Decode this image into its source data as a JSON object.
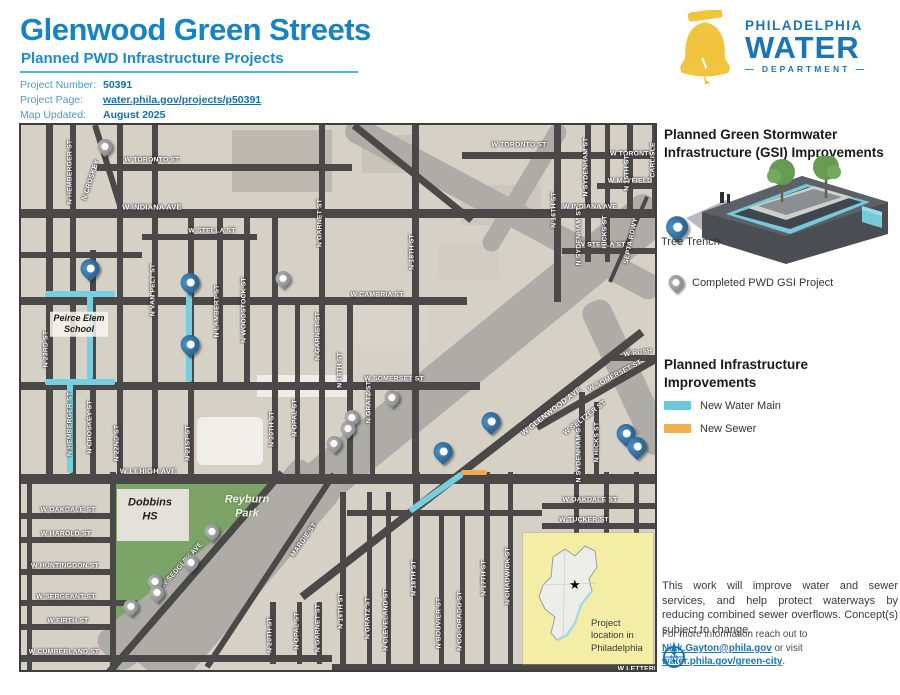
{
  "header": {
    "title": "Glenwood Green Streets",
    "subtitle": "Planned PWD Infrastructure Projects",
    "info": [
      {
        "label": "Project Number:",
        "value": "50391",
        "link": false
      },
      {
        "label": "Project Page:",
        "value": "water.phila.gov/projects/p50391",
        "link": true
      },
      {
        "label": "Map Updated:",
        "value": "August 2025",
        "link": false
      }
    ],
    "logo": {
      "line1": "PHILADELPHIA",
      "line2": "WATER",
      "line3": "DEPARTMENT"
    }
  },
  "colors": {
    "brand_blue": "#1b74b8",
    "title_blue": "#1583c4",
    "bell_yellow": "#f0c43c",
    "water_main": "#74d0e0",
    "sewer": "#f0a94e",
    "pin_blue": "#2e6da4",
    "pin_gray": "#8c8c8c",
    "park_green": "#7ba466",
    "inset_yellow": "#f3eda6"
  },
  "sidebar": {
    "gsi_heading": "Planned Green Stormwater Infrastructure (GSI) Improvements",
    "tree_trench_label": "Tree Trench",
    "completed_label": "Completed PWD GSI Project",
    "infra_heading": "Planned Infrastructure Improvements",
    "legend": [
      {
        "label": "New Water Main",
        "color": "#6cc8da"
      },
      {
        "label": "New Sewer",
        "color": "#f2b04f"
      }
    ],
    "paragraph": "This work will improve water and sewer services, and help protect waterways by reducing combined sewer overflows. Concept(s) subject to change.",
    "contact_prefix": "For more information reach out to ",
    "contact_email": "Nick.Gayton@phila.gov",
    "contact_mid": " or visit ",
    "contact_link": "water.phila.gov/green-city",
    "contact_suffix": "."
  },
  "map": {
    "inset_caption": "Project location in Philadelphia",
    "inset_star": "★",
    "places": [
      {
        "text": "Peirce Elem School",
        "x": 58,
        "y": 199,
        "w": 52,
        "size": 9,
        "style": "bg"
      },
      {
        "text": "Dobbins HS",
        "x": 129,
        "y": 385,
        "w": 50,
        "size": 11,
        "style": "bg-none"
      },
      {
        "text": "Reyburn Park",
        "x": 226,
        "y": 382,
        "w": 52,
        "size": 11,
        "style": "light"
      }
    ],
    "streets_h": [
      [
        39,
        76,
        331,
        7
      ],
      [
        27,
        441,
        638,
        7
      ],
      [
        84,
        0,
        638,
        9
      ],
      [
        109,
        121,
        236,
        6
      ],
      [
        123,
        541,
        638,
        6
      ],
      [
        172,
        0,
        446,
        8
      ],
      [
        257,
        0,
        459,
        8
      ],
      [
        349,
        0,
        638,
        10
      ],
      [
        388,
        0,
        93,
        6
      ],
      [
        378,
        521,
        638,
        6
      ],
      [
        412,
        0,
        93,
        6
      ],
      [
        444,
        0,
        93,
        6
      ],
      [
        475,
        0,
        116,
        6
      ],
      [
        499,
        0,
        93,
        6
      ],
      [
        530,
        0,
        311,
        7
      ],
      [
        398,
        521,
        638,
        6
      ],
      [
        58,
        576,
        638,
        6
      ],
      [
        230,
        589,
        638,
        6
      ],
      [
        539,
        311,
        638,
        7
      ],
      [
        385,
        326,
        521,
        6
      ],
      [
        127,
        0,
        121,
        6
      ]
    ],
    "streets_v": [
      [
        25,
        0,
        349,
        7
      ],
      [
        49,
        0,
        349,
        6
      ],
      [
        69,
        125,
        349,
        6
      ],
      [
        96,
        0,
        349,
        6
      ],
      [
        131,
        0,
        349,
        6
      ],
      [
        167,
        84,
        349,
        6
      ],
      [
        196,
        84,
        257,
        6
      ],
      [
        223,
        84,
        257,
        6
      ],
      [
        251,
        84,
        349,
        6
      ],
      [
        274,
        172,
        349,
        5
      ],
      [
        298,
        0,
        349,
        6
      ],
      [
        326,
        172,
        349,
        6
      ],
      [
        349,
        257,
        349,
        5
      ],
      [
        391,
        0,
        349,
        7
      ],
      [
        533,
        0,
        177,
        7
      ],
      [
        564,
        0,
        137,
        6
      ],
      [
        584,
        0,
        137,
        5
      ],
      [
        606,
        0,
        84,
        6
      ],
      [
        631,
        0,
        84,
        6
      ],
      [
        558,
        267,
        349,
        6
      ],
      [
        573,
        277,
        349,
        5
      ],
      [
        249,
        477,
        539,
        6
      ],
      [
        276,
        477,
        539,
        5
      ],
      [
        296,
        477,
        539,
        5
      ],
      [
        319,
        367,
        539,
        6
      ],
      [
        346,
        367,
        539,
        5
      ],
      [
        365,
        367,
        539,
        5
      ],
      [
        392,
        347,
        539,
        7
      ],
      [
        418,
        387,
        539,
        5
      ],
      [
        439,
        387,
        539,
        5
      ],
      [
        463,
        347,
        539,
        6
      ],
      [
        487,
        347,
        539,
        5
      ],
      [
        553,
        347,
        539,
        5
      ],
      [
        583,
        347,
        539,
        5
      ],
      [
        613,
        347,
        539,
        5
      ],
      [
        6,
        357,
        549,
        5
      ],
      [
        89,
        347,
        549,
        6
      ]
    ],
    "streets_d": [
      [
        74,
        0,
        101,
        87,
        6
      ],
      [
        333,
        0,
        451,
        95,
        7
      ],
      [
        621,
        207,
        281,
        472,
        8
      ],
      [
        516,
        302,
        638,
        232,
        7
      ],
      [
        313,
        349,
        186,
        542,
        6
      ],
      [
        261,
        347,
        86,
        549,
        7
      ],
      [
        589,
        157,
        626,
        72,
        4
      ]
    ],
    "gray_bands": [
      [
        638,
        82,
        86,
        532,
        46
      ],
      [
        300,
        349,
        130,
        549,
        60
      ],
      [
        326,
        0,
        638,
        167,
        26
      ],
      [
        541,
        0,
        466,
        125,
        18
      ],
      [
        571,
        177,
        641,
        327,
        30
      ]
    ],
    "water_main": {
      "h": [
        [
          166,
          24,
          94,
          6
        ],
        [
          254,
          24,
          94,
          6
        ]
      ],
      "v": [
        [
          66,
          166,
          254,
          6
        ],
        [
          46,
          254,
          348,
          6
        ],
        [
          165,
          169,
          257,
          6
        ]
      ],
      "d": [
        [
          389,
          386,
          441,
          349,
          6
        ]
      ]
    },
    "sewer": {
      "h": [
        [
          345,
          440,
          466,
          5
        ]
      ]
    },
    "pins_blue": [
      [
        69,
        153
      ],
      [
        169,
        167
      ],
      [
        169,
        229
      ],
      [
        422,
        336
      ],
      [
        470,
        306
      ],
      [
        605,
        318
      ],
      [
        616,
        331
      ]
    ],
    "pins_gray": [
      [
        84,
        29
      ],
      [
        262,
        161
      ],
      [
        371,
        280
      ],
      [
        331,
        300
      ],
      [
        327,
        311
      ],
      [
        313,
        326
      ],
      [
        191,
        414
      ],
      [
        170,
        445
      ],
      [
        134,
        464
      ],
      [
        136,
        475
      ],
      [
        110,
        489
      ]
    ],
    "labels": [
      [
        "W TORONTO ST",
        131,
        35,
        0
      ],
      [
        "W TORONTO ST",
        498,
        20,
        0
      ],
      [
        "W TORONTO",
        611,
        29,
        0
      ],
      [
        "W INDIANA AVE",
        131,
        82,
        0,
        7.5
      ],
      [
        "W INDIANA AVE",
        569,
        82,
        0
      ],
      [
        "W STELLA ST",
        191,
        106,
        0
      ],
      [
        "W STELLA ST",
        581,
        120,
        0
      ],
      [
        "W CAMBRIA ST",
        356,
        170,
        0
      ],
      [
        "W SOMERSET ST",
        373,
        254,
        0
      ],
      [
        "W LEHIGH AVE",
        127,
        346,
        0,
        7.5
      ],
      [
        "W OAKDALE ST",
        47,
        385,
        0
      ],
      [
        "W OAKDALE ST",
        569,
        375,
        0
      ],
      [
        "W HAROLD ST",
        45,
        409,
        0
      ],
      [
        "W HUNTINGDON ST",
        44,
        441,
        0
      ],
      [
        "W SERGEANT ST",
        45,
        472,
        0
      ],
      [
        "W FIRTH ST",
        47,
        496,
        0
      ],
      [
        "W CUMBERLAND ST",
        43,
        527,
        0
      ],
      [
        "W TUCKER ST",
        563,
        395,
        0
      ],
      [
        "W MAYFIELD",
        609,
        56,
        0
      ],
      [
        "W RUSH",
        617,
        228,
        -8
      ],
      [
        "W LETTERLY",
        619,
        544,
        0
      ],
      [
        "N HEMBERGER ST",
        49,
        47,
        -90
      ],
      [
        "N CROSKEY",
        70,
        55,
        -72
      ],
      [
        "N 23RD ST",
        25,
        224,
        -90
      ],
      [
        "N HEMBERGER ST",
        49,
        299,
        -90
      ],
      [
        "N CROSKEY ST",
        69,
        302,
        -90
      ],
      [
        "N 22ND ST",
        96,
        318,
        -90
      ],
      [
        "N VAN PELT ST",
        132,
        165,
        -90
      ],
      [
        "N 21ST ST",
        167,
        318,
        -90
      ],
      [
        "N LAMBERT ST",
        196,
        186,
        -90
      ],
      [
        "N WOODSTOCK ST",
        223,
        185,
        -90
      ],
      [
        "N 20TH ST",
        251,
        304,
        -90
      ],
      [
        "N OPAL ST",
        274,
        293,
        -90
      ],
      [
        "N GARNET ST",
        299,
        98,
        -90
      ],
      [
        "N GARNET ST",
        297,
        211,
        -90
      ],
      [
        "N 19TH ST",
        319,
        245,
        -90
      ],
      [
        "N GRATZ ST",
        348,
        277,
        -90
      ],
      [
        "N 18TH ST",
        391,
        127,
        -90
      ],
      [
        "N 16TH ST",
        533,
        85,
        -90
      ],
      [
        "N SYDENHAM ST",
        565,
        42,
        -90
      ],
      [
        "N SYDENHAM ST",
        558,
        111,
        -90
      ],
      [
        "HICKS ST",
        584,
        107,
        -90
      ],
      [
        "N 15TH ST",
        606,
        48,
        -90
      ],
      [
        "CARLISLE",
        632,
        35,
        -90
      ],
      [
        "SEPTA RDWY",
        610,
        116,
        -78
      ],
      [
        "N SYDENHAM ST",
        558,
        328,
        -90
      ],
      [
        "N HICKS ST",
        576,
        317,
        -90
      ],
      [
        "W SELTZER ST",
        564,
        293,
        -38
      ],
      [
        "W GLENWOOD AVE",
        530,
        286,
        -38,
        7.5
      ],
      [
        "W SOMERSET ST",
        594,
        251,
        -28
      ],
      [
        "MARGIE ST",
        283,
        415,
        -55
      ],
      [
        "W SEDGLEY AVE",
        161,
        440,
        -48
      ],
      [
        "N 20TH ST",
        249,
        510,
        -90
      ],
      [
        "N OPAL ST",
        276,
        506,
        -90
      ],
      [
        "N GARNET ST",
        297,
        503,
        -90
      ],
      [
        "N 19TH ST",
        320,
        486,
        -90
      ],
      [
        "N GRATZ ST",
        347,
        493,
        -90
      ],
      [
        "N CLEVELAND ST",
        365,
        495,
        -90
      ],
      [
        "N 18TH ST",
        393,
        453,
        -90
      ],
      [
        "N BOUVIER ST",
        418,
        498,
        -90
      ],
      [
        "N COLORADO ST",
        439,
        496,
        -90
      ],
      [
        "N 17TH ST",
        463,
        453,
        -90
      ],
      [
        "N CHADWICK ST",
        487,
        451,
        -90
      ]
    ]
  }
}
